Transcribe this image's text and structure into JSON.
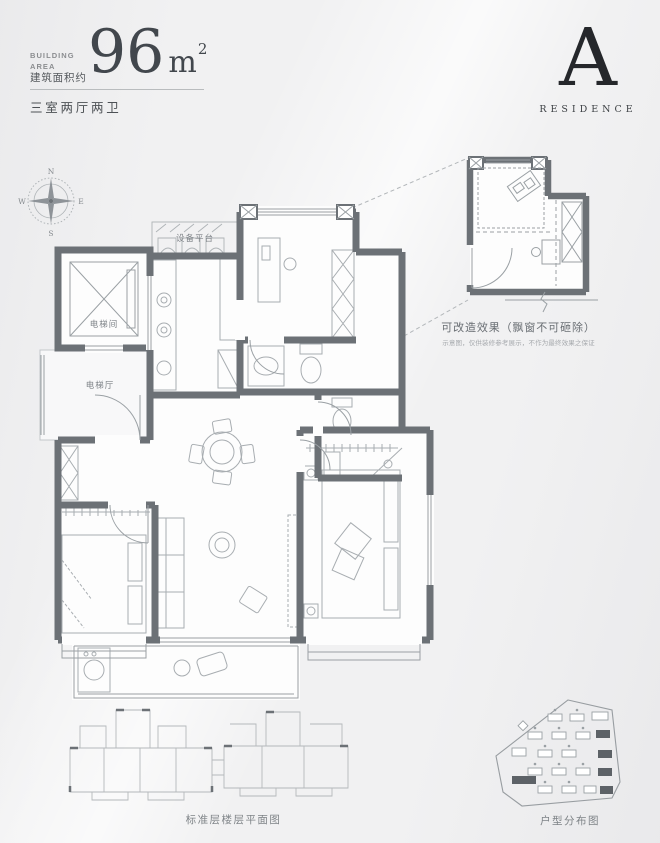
{
  "header": {
    "building_area_label": "BUILDING AREA",
    "area_prefix_cn": "建筑面积约",
    "area_number": "96",
    "area_unit": "m",
    "area_exponent": "2",
    "unit_layout": "三室两厅两卫"
  },
  "brand": {
    "letter": "A",
    "name": "RESIDENCE"
  },
  "compass": {
    "north": "N",
    "south": "S",
    "east": "E",
    "west": "W"
  },
  "plan_labels": {
    "equipment_platform": "设备平台",
    "elevator_shaft": "电梯间",
    "elevator_hall": "电梯厅"
  },
  "inset": {
    "title": "可改造效果（飘窗不可砸除）",
    "disclaimer": "示意图，仅供装修参考展示，不作为最终效果之保证"
  },
  "captions": {
    "standard_floor": "标准层楼层平面图",
    "unit_distribution": "户型分布图"
  },
  "colors": {
    "wall": "#6c7176",
    "background": "#f1f1f2",
    "accent": "#26282c"
  }
}
